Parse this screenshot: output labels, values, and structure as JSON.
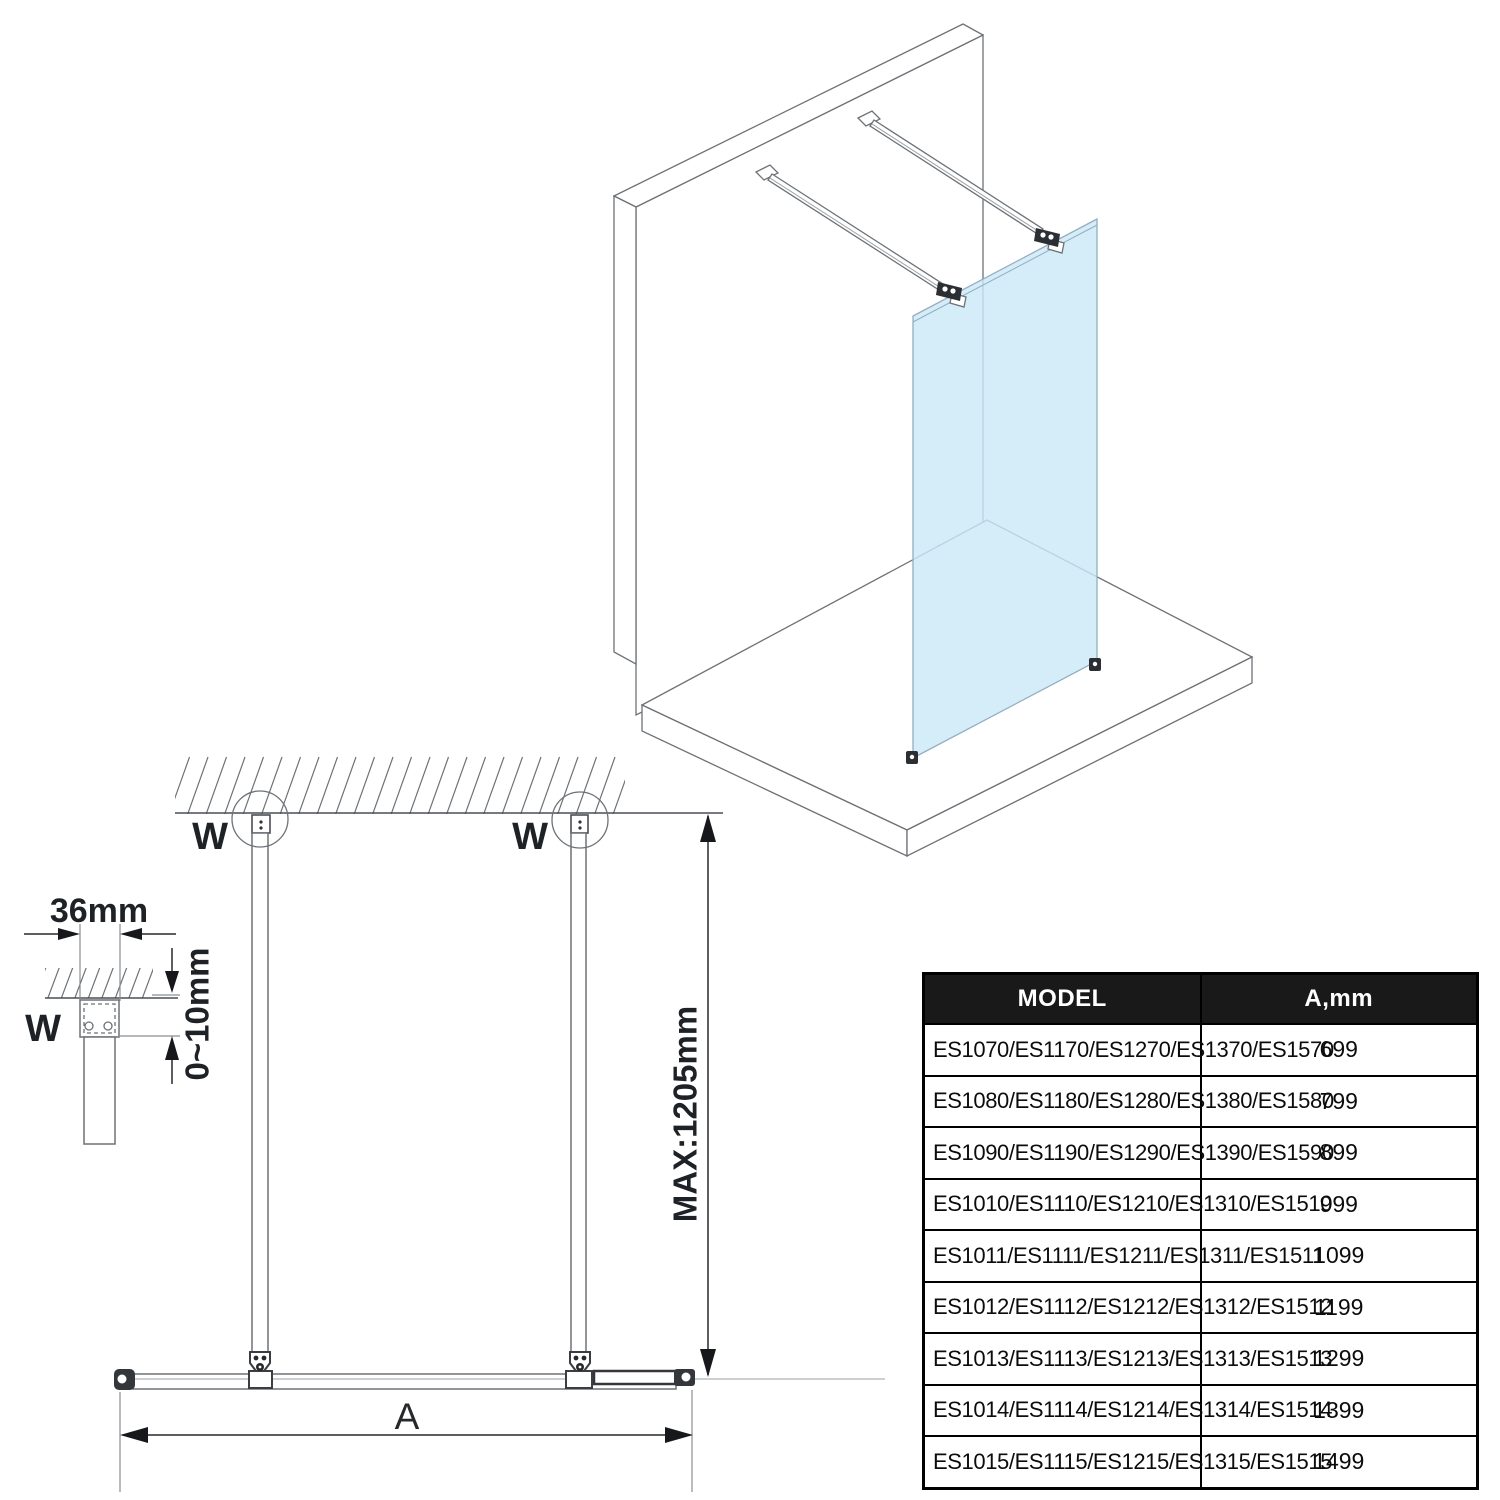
{
  "drawing": {
    "type": "shower walk-in glass panel installation diagram",
    "colors": {
      "glass_blue": "#cce8f8",
      "line_gray": "#6d7277",
      "dimension_black": "#26282b",
      "table_header_bg": "#191919",
      "table_header_text": "#ffffff"
    },
    "labels": {
      "bracket_width": "36mm",
      "gap_range": "0~10mm",
      "max_bar_length": "MAX:1205mm",
      "width_dim": "A"
    },
    "wall_markers": {
      "detail": "W",
      "left": "W",
      "right": "W"
    }
  },
  "table": {
    "header": {
      "model": "MODEL",
      "a_mm": "A,mm"
    },
    "rows": [
      {
        "model": "ES1070/ES1170/ES1270/ES1370/ES1570",
        "a": "699"
      },
      {
        "model": "ES1080/ES1180/ES1280/ES1380/ES1580",
        "a": "799"
      },
      {
        "model": "ES1090/ES1190/ES1290/ES1390/ES1590",
        "a": "899"
      },
      {
        "model": "ES1010/ES1110/ES1210/ES1310/ES1510",
        "a": "999"
      },
      {
        "model": "ES1011/ES1111/ES1211/ES1311/ES1511",
        "a": "1099"
      },
      {
        "model": "ES1012/ES1112/ES1212/ES1312/ES1512",
        "a": "1199"
      },
      {
        "model": "ES1013/ES1113/ES1213/ES1313/ES1513",
        "a": "1299"
      },
      {
        "model": "ES1014/ES1114/ES1214/ES1314/ES1514",
        "a": "1399"
      },
      {
        "model": "ES1015/ES1115/ES1215/ES1315/ES1515",
        "a": "1499"
      }
    ]
  }
}
